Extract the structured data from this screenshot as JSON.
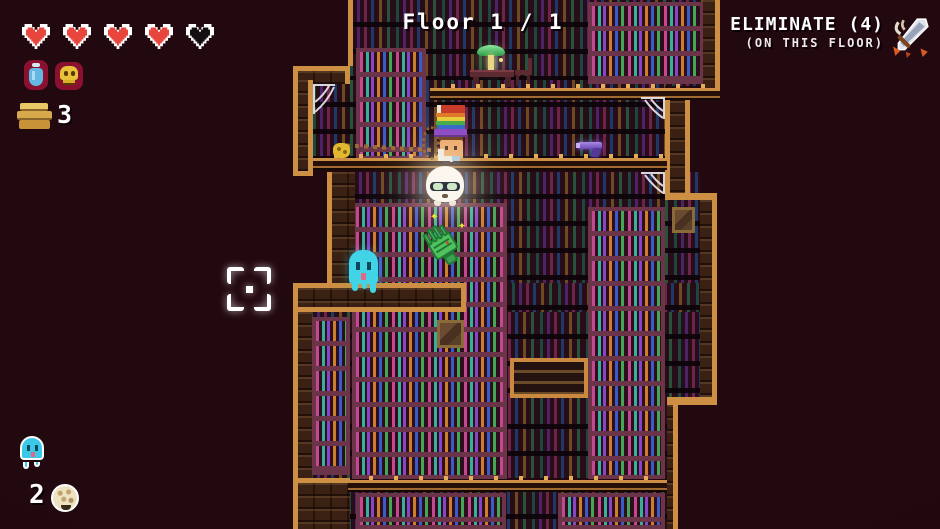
{
  "hud": {
    "hearts": {
      "total": 5,
      "filled": 4,
      "full_icon": "heart-full-icon",
      "empty_icon": "heart-empty-icon"
    },
    "items": {
      "potion_icon": "potion-icon",
      "skull_icon": "skull-icon"
    },
    "books": {
      "icon": "books-icon",
      "count": "3"
    },
    "floor": {
      "label": "Floor 1 / 1"
    },
    "objective": {
      "title": "ELIMINATE (4)",
      "subtitle": "(ON THIS FLOOR)",
      "icon": "crossed-weapons-icon"
    },
    "captures": {
      "ghost_icon": "ghost-icon",
      "count": "2",
      "puff_icon": "puff-icon"
    },
    "reticle_icon": "crosshair-reticle"
  },
  "world": {
    "entities": {
      "player": "librarian-player",
      "enemy1": "ghost-enemy",
      "enemy2": "hand-enemy",
      "enemy3": "puffball-enemy",
      "pickup": "gun-pickup",
      "props": [
        "desk-lamp",
        "desk",
        "chair",
        "bench",
        "portrait",
        "spiderweb"
      ]
    }
  },
  "colors": {
    "background": "#22080f",
    "wall_brick": "#3b2113",
    "trim_gold": "#cd8f43",
    "room_bg": "#270d18",
    "bookcase_frame": "#6b3449",
    "heart_red": "#e8463c",
    "ghost_cyan": "#41d4e6",
    "hand_green": "#52c25e",
    "puff_white": "#fbf7ee",
    "lamp_green": "#58c868",
    "text_white": "#ffffff"
  }
}
